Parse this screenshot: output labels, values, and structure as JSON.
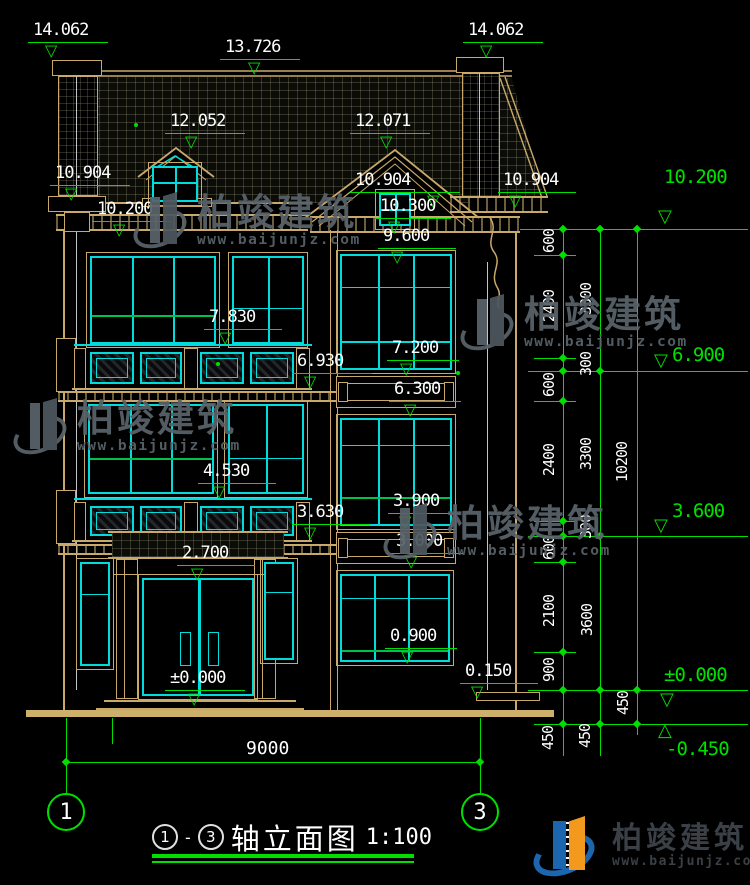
{
  "drawing": {
    "title_axis_start": "1",
    "title_sep": "-",
    "title_axis_end": "3",
    "title_text": "轴立面图",
    "title_scale": "1:100",
    "axis_bubble_left": "1",
    "axis_bubble_right": "3",
    "overall_width_dim": "9000"
  },
  "levels_white": [
    "14.062",
    "13.726",
    "14.062",
    "12.052",
    "12.071",
    "10.904",
    "10.200",
    "10.904",
    "10.300",
    "9.600",
    "10.904",
    "7.830",
    "6.930",
    "7.200",
    "6.300",
    "4.530",
    "3.630",
    "3.900",
    "3.000",
    "2.700",
    "±0.000",
    "0.900",
    "0.150"
  ],
  "levels_green": [
    "10.200",
    "6.900",
    "3.600",
    "±0.000",
    "-0.450"
  ],
  "dim_chain_inner": [
    "600",
    "2400",
    "300",
    "600",
    "2400",
    "300",
    "600",
    "2100",
    "900",
    "450"
  ],
  "dim_chain_mid": [
    "3300",
    "3300",
    "3600",
    "450"
  ],
  "dim_chain_outer": [
    "10200",
    "450"
  ],
  "watermark": {
    "brand": "柏竣建筑",
    "url": "www.baijunjz.com"
  },
  "footer_logo": {
    "brand": "柏竣建筑",
    "url": "www.baijunjz.com"
  },
  "colors": {
    "dimension": "#00e000",
    "window_frame": "#00dcdc",
    "trim": "#c9a96a",
    "label": "#ffffff",
    "background": "#000000"
  }
}
